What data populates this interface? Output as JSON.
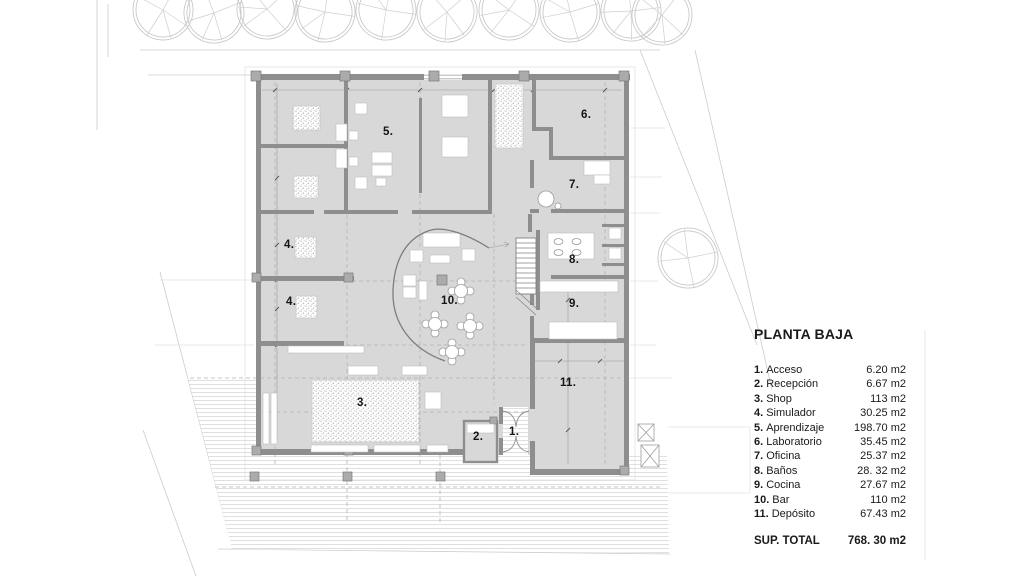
{
  "title": "PLANTA BAJA",
  "legend": {
    "items": [
      {
        "num": "1.",
        "name": "Acceso",
        "area": "6.20 m2"
      },
      {
        "num": "2.",
        "name": "Recepción",
        "area": "6.67 m2"
      },
      {
        "num": "3.",
        "name": "Shop",
        "area": "113 m2"
      },
      {
        "num": "4.",
        "name": "Simulador",
        "area": "30.25 m2"
      },
      {
        "num": "5.",
        "name": "Aprendizaje",
        "area": "198.70 m2"
      },
      {
        "num": "6.",
        "name": "Laboratorio",
        "area": "35.45 m2"
      },
      {
        "num": "7.",
        "name": "Oficina",
        "area": "25.37 m2"
      },
      {
        "num": "8.",
        "name": "Baños",
        "area": "28. 32 m2"
      },
      {
        "num": "9.",
        "name": "Cocina",
        "area": "27.67 m2"
      },
      {
        "num": "10.",
        "name": "Bar",
        "area": "110 m2"
      },
      {
        "num": "11.",
        "name": "Depósito",
        "area": "67.43 m2"
      }
    ],
    "total_label": "SUP. TOTAL",
    "total_value": "768. 30 m2"
  },
  "plan": {
    "room_labels": [
      "5.",
      "4.",
      "4.",
      "3.",
      "10.",
      "2.",
      "1.",
      "6.",
      "7.",
      "8.",
      "9.",
      "11."
    ]
  },
  "colors": {
    "floor_fill": "#d8d8d8",
    "wall": "#8e8e8e",
    "line_light": "#cccccc"
  }
}
